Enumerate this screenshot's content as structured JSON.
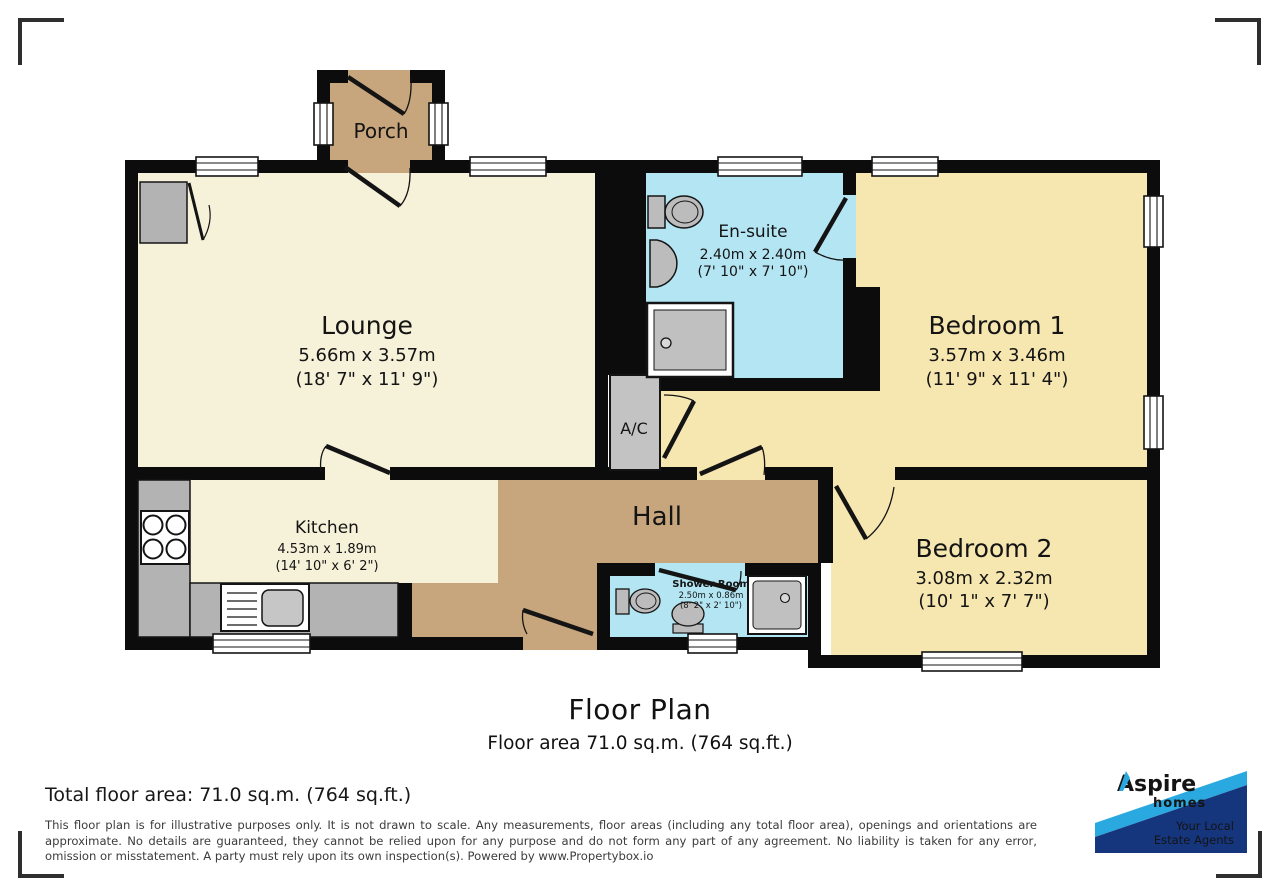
{
  "rooms": {
    "porch": {
      "name": "Porch"
    },
    "lounge": {
      "name": "Lounge",
      "dims_m": "5.66m x 3.57m",
      "dims_ft": "(18' 7\" x 11' 9\")"
    },
    "ensuite": {
      "name": "En-suite",
      "dims_m": "2.40m x 2.40m",
      "dims_ft": "(7' 10\" x 7' 10\")"
    },
    "bedroom1": {
      "name": "Bedroom 1",
      "dims_m": "3.57m x 3.46m",
      "dims_ft": "(11' 9\" x 11' 4\")"
    },
    "kitchen": {
      "name": "Kitchen",
      "dims_m": "4.53m x 1.89m",
      "dims_ft": "(14' 10\" x 6' 2\")"
    },
    "hall": {
      "name": "Hall"
    },
    "shower_room": {
      "name": "Shower Room",
      "dims_m": "2.50m x 0.86m",
      "dims_ft": "(8' 2\" x 2' 10\")"
    },
    "bedroom2": {
      "name": "Bedroom 2",
      "dims_m": "3.08m x 2.32m",
      "dims_ft": "(10' 1\" x 7' 7\")"
    },
    "ac": {
      "name": "A/C"
    }
  },
  "title": {
    "heading": "Floor Plan",
    "subtitle": "Floor area 71.0 sq.m. (764 sq.ft.)"
  },
  "footer": {
    "total_area": "Total floor area: 71.0 sq.m. (764 sq.ft.)",
    "disclaimer": "This floor plan is for illustrative purposes only. It is not drawn to scale. Any measurements, floor areas (including any total floor area), openings and orientations are approximate. No details are guaranteed, they cannot be relied upon for any purpose and do not form any part of any agreement. No liability is taken for any error, omission or misstatement. A party must rely upon its own inspection(s). Powered by www.Propertybox.io"
  },
  "logo": {
    "brand": "Aspire",
    "brand_sub": "homes",
    "tagline_line1": "Your Local",
    "tagline_line2": "Estate Agents"
  },
  "colors": {
    "wall": "#0c0c0c",
    "floor_cream": "#f6f1d9",
    "floor_yellow": "#f6e6b0",
    "floor_blue": "#b4e5f3",
    "floor_tan": "#c7a57d",
    "fixture_gray": "#bcbcbc",
    "counter_gray": "#b3b3b3",
    "logo_navy": "#15357d",
    "logo_blue": "#1b75bc",
    "logo_light_blue": "#29a9e0"
  }
}
